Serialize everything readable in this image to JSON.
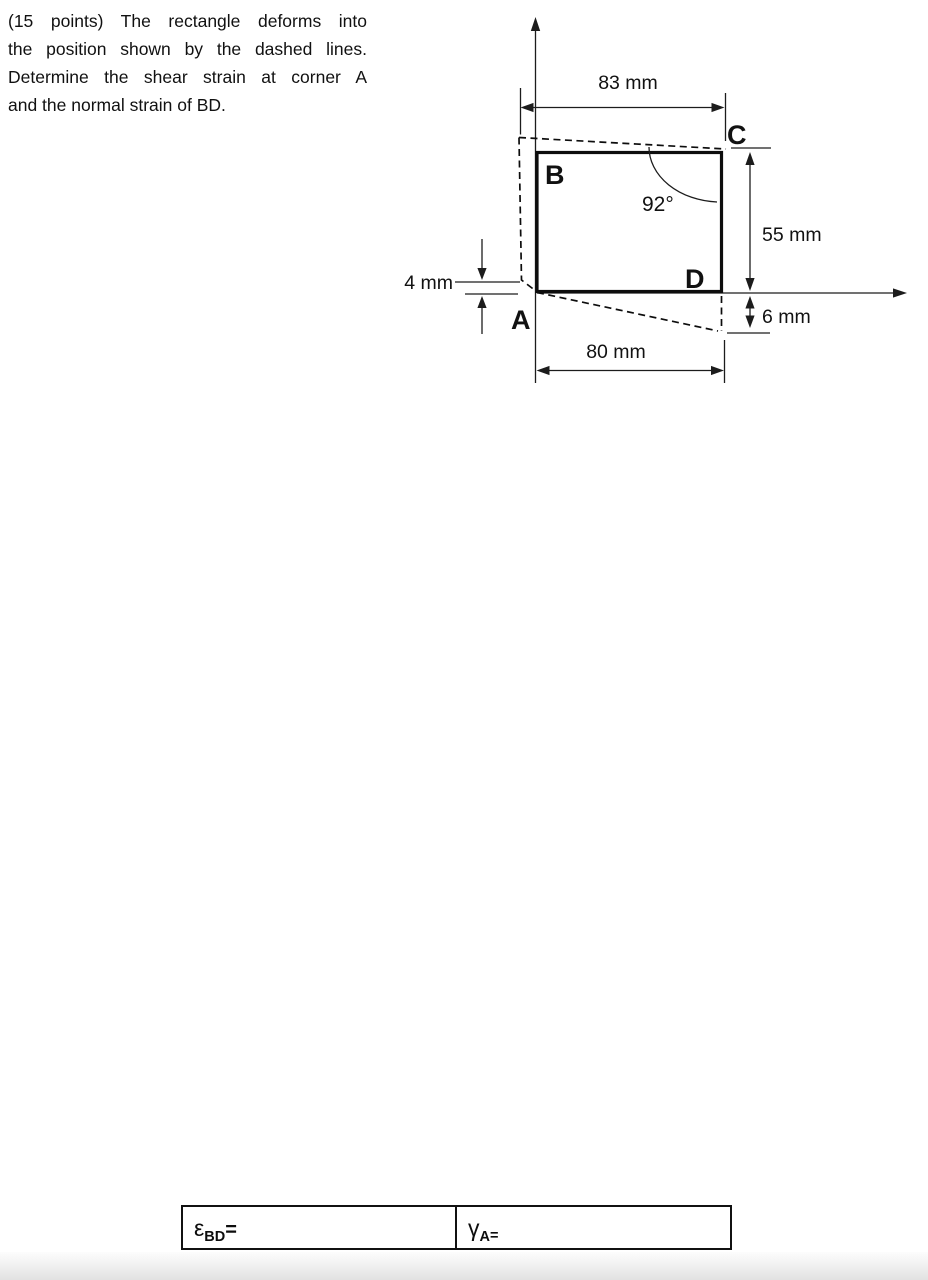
{
  "problem": {
    "lines": [
      "(15 points) The rectangle deforms into",
      "the position shown by the dashed lines.",
      "Determine the shear strain at corner A",
      "and the normal strain of BD."
    ]
  },
  "diagram": {
    "corner_labels": {
      "a": "A",
      "b": "B",
      "c": "C",
      "d": "D"
    },
    "dims": {
      "top_width": "83 mm",
      "bottom_width": "80 mm",
      "right_height": "55 mm",
      "left_offset": "4 mm",
      "right_offset": "6 mm",
      "angle": "92°"
    },
    "line_color": "#111111"
  },
  "answer_table": {
    "epsilon": {
      "symbol": "ε",
      "subscript": "BD",
      "equals": "="
    },
    "gamma": {
      "symbol": "γ",
      "subscript": "A",
      "equals": "="
    }
  }
}
